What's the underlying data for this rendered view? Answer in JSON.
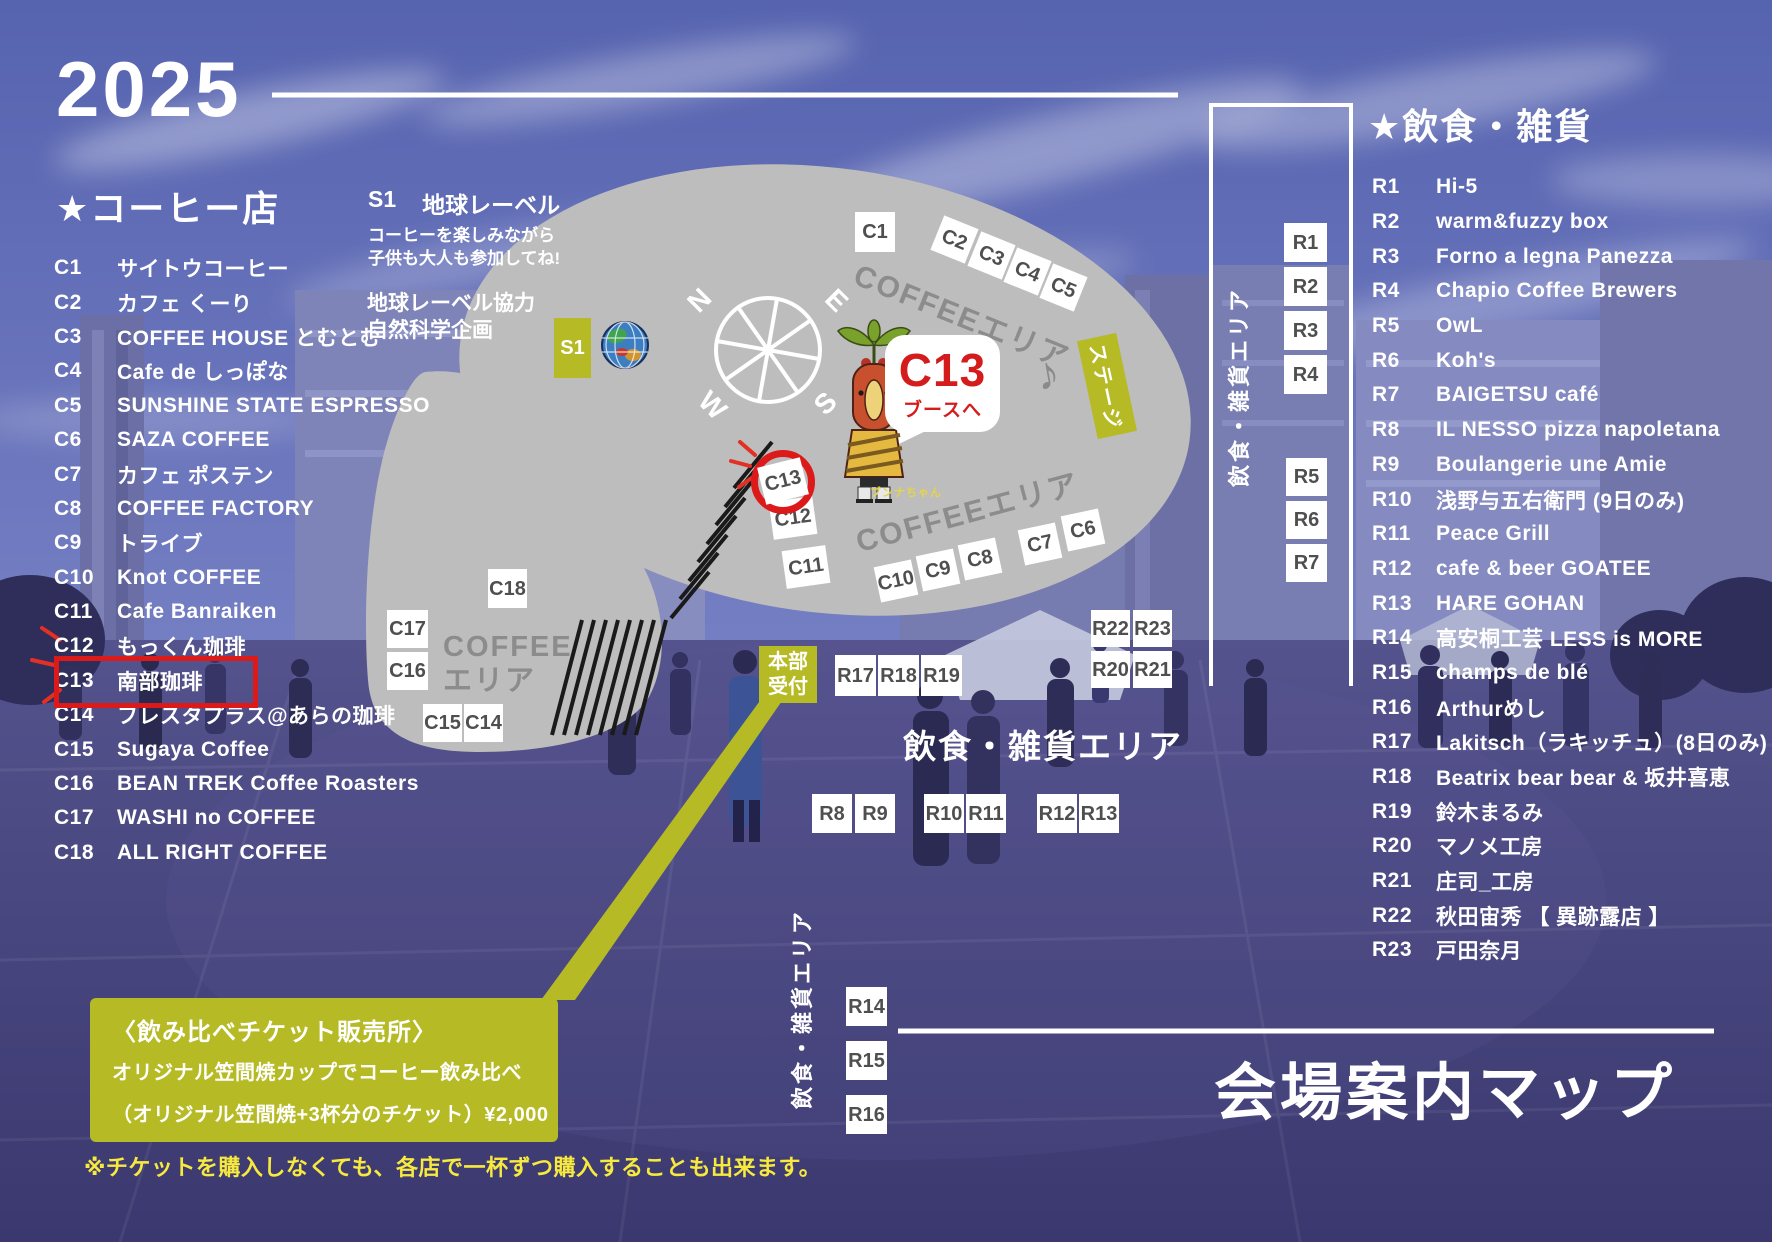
{
  "year": "2025",
  "venue_title": "会場案内マップ",
  "coffee_list": {
    "header": "★コーヒー店",
    "items": [
      {
        "code": "C1",
        "name": "サイトウコーヒー"
      },
      {
        "code": "C2",
        "name": "カフェ くーり"
      },
      {
        "code": "C3",
        "name": "COFFEE HOUSE とむとむ"
      },
      {
        "code": "C4",
        "name": "Cafe de しっぽな"
      },
      {
        "code": "C5",
        "name": "SUNSHINE STATE ESPRESSO"
      },
      {
        "code": "C6",
        "name": "SAZA COFFEE"
      },
      {
        "code": "C7",
        "name": "カフェ ポステン"
      },
      {
        "code": "C8",
        "name": "COFFEE FACTORY"
      },
      {
        "code": "C9",
        "name": "トライブ"
      },
      {
        "code": "C10",
        "name": "Knot COFFEE"
      },
      {
        "code": "C11",
        "name": "Cafe Banraiken"
      },
      {
        "code": "C12",
        "name": "もっくん珈琲"
      },
      {
        "code": "C13",
        "name": "南部珈琲"
      },
      {
        "code": "C14",
        "name": "フレスタプラス@あらの珈琲"
      },
      {
        "code": "C15",
        "name": "Sugaya Coffee"
      },
      {
        "code": "C16",
        "name": "BEAN TREK Coffee Roasters"
      },
      {
        "code": "C17",
        "name": "WASHI no COFFEE"
      },
      {
        "code": "C18",
        "name": "ALL RIGHT COFFEE"
      }
    ]
  },
  "food_list": {
    "header": "★飲食・雑貨",
    "items": [
      {
        "code": "R1",
        "name": "Hi-5"
      },
      {
        "code": "R2",
        "name": "warm&fuzzy box"
      },
      {
        "code": "R3",
        "name": "Forno a legna Panezza"
      },
      {
        "code": "R4",
        "name": "Chapio Coffee Brewers"
      },
      {
        "code": "R5",
        "name": "OwL"
      },
      {
        "code": "R6",
        "name": "Koh's"
      },
      {
        "code": "R7",
        "name": "BAIGETSU café"
      },
      {
        "code": "R8",
        "name": "IL NESSO pizza napoletana"
      },
      {
        "code": "R9",
        "name": "Boulangerie une Amie"
      },
      {
        "code": "R10",
        "name": "浅野与五右衛門 (9日のみ)"
      },
      {
        "code": "R11",
        "name": "Peace Grill"
      },
      {
        "code": "R12",
        "name": "cafe & beer GOATEE"
      },
      {
        "code": "R13",
        "name": "HARE GOHAN"
      },
      {
        "code": "R14",
        "name": "高安桐工芸 LESS is MORE"
      },
      {
        "code": "R15",
        "name": "champs de blé"
      },
      {
        "code": "R16",
        "name": "Arthurめし"
      },
      {
        "code": "R17",
        "name": "Lakitsch（ラキッチュ）(8日のみ)"
      },
      {
        "code": "R18",
        "name": "Beatrix bear bear & 坂井喜恵"
      },
      {
        "code": "R19",
        "name": "鈴木まるみ"
      },
      {
        "code": "R20",
        "name": "マノメ工房"
      },
      {
        "code": "R21",
        "name": "庄司_工房"
      },
      {
        "code": "R22",
        "name": "秋田宙秀 【 異跡露店 】"
      },
      {
        "code": "R23",
        "name": "戸田奈月"
      }
    ]
  },
  "s1_info": {
    "code": "S1",
    "name": "地球レーベル",
    "desc_line1": "コーヒーを楽しみながら",
    "desc_line2": "子供も大人も参加してね!",
    "coop_line1": "地球レーベル協力",
    "coop_line2": "自然科学企画"
  },
  "map": {
    "booths": {
      "s1": "S1",
      "c1": "C1",
      "c2": "C2",
      "c3": "C3",
      "c4": "C4",
      "c5": "C5",
      "c6": "C6",
      "c7": "C7",
      "c8": "C8",
      "c9": "C9",
      "c10": "C10",
      "c11": "C11",
      "c12": "C12",
      "c13": "C13",
      "c14": "C14",
      "c15": "C15",
      "c16": "C16",
      "c17": "C17",
      "c18": "C18",
      "r1": "R1",
      "r2": "R2",
      "r3": "R3",
      "r4": "R4",
      "r5": "R5",
      "r6": "R6",
      "r7": "R7",
      "r8": "R8",
      "r9": "R9",
      "r10": "R10",
      "r11": "R11",
      "r12": "R12",
      "r13": "R13",
      "r14": "R14",
      "r15": "R15",
      "r16": "R16",
      "r17": "R17",
      "r18": "R18",
      "r19": "R19",
      "r20": "R20",
      "r21": "R21",
      "r22": "R22",
      "r23": "R23"
    },
    "labels": {
      "coffee_area_top": "COFFEEエリア",
      "coffee_area_bottom": "COFFEEエリア",
      "coffee_area_blob_line1": "COFFEE",
      "coffee_area_blob_line2": "エリア",
      "stage": "ステージ",
      "reception_line1": "本部",
      "reception_line2": "受付",
      "food_goods_heading": "飲食・雑貨エリア",
      "food_goods_vertical_right": "飲食・雑貨エリア",
      "food_goods_vertical_bottom": "飲食・雑貨エリア",
      "mascot_name": "ブンナちゃん",
      "music_note": "♪"
    },
    "compass": {
      "n": "N",
      "e": "E",
      "s": "S",
      "w": "W"
    },
    "callout": {
      "code": "C13",
      "text": "ブースへ"
    }
  },
  "ticket_box": {
    "line1": "〈飲み比べチケット販売所〉",
    "line2": "オリジナル笠間焼カップでコーヒー飲み比べ",
    "line3": "（オリジナル笠間焼+3杯分のチケット）¥2,000"
  },
  "footnote": "※チケットを購入しなくても、各店で一杯ずつ購入することも出来ます。",
  "colors": {
    "map_gray": "#bdbdbd",
    "accent_yellow_green": "#b5ba25",
    "highlight_red": "#dc1a1a",
    "footnote_yellow": "#f7e93d",
    "sky_blue": "#5d69b5"
  }
}
